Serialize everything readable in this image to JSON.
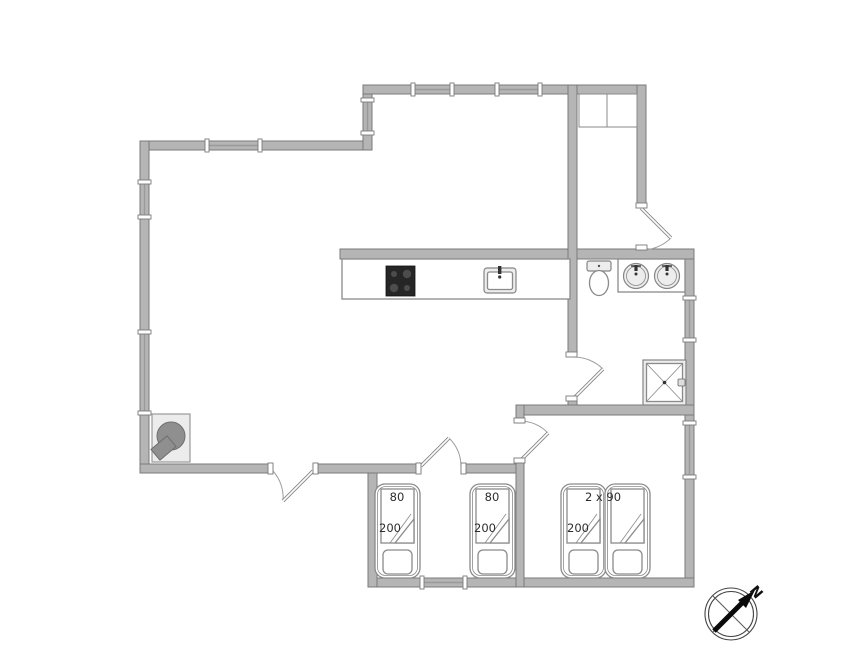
{
  "beds": {
    "single_1": {
      "width": "80",
      "length": "200"
    },
    "single_2": {
      "width": "80",
      "length": "200"
    },
    "double": {
      "size": "2 x 90",
      "length": "200"
    }
  },
  "compass": {
    "north": "N"
  },
  "colors": {
    "background": "#ffffff",
    "wall_fill": "#b5b5b5",
    "wall_stroke": "#7a7a7a",
    "furniture_stroke": "#8a8a8a",
    "stove_dark": "#262626"
  }
}
